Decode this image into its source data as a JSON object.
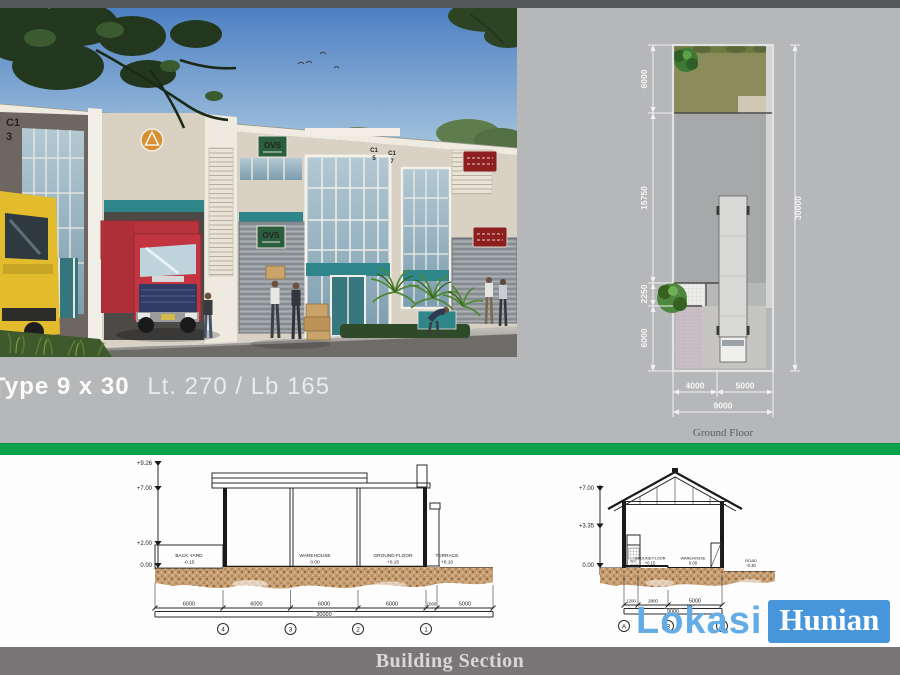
{
  "hero": {
    "caption_bold": "Type 9 x 30",
    "caption_light": "Lt. 270 / Lb 165",
    "signs": {
      "ovs": "OVS",
      "unit1_line1": "C1",
      "unit1_line2": "3",
      "unit2_line1": "C1",
      "unit2_line2": "5",
      "unit3_line1": "C1",
      "unit3_line2": "7"
    }
  },
  "floor_plan": {
    "title": "Ground Floor",
    "left_dims": [
      "6000",
      "15750",
      "2250",
      "6000"
    ],
    "right_dim": "30000",
    "bottom_dims": [
      "4000",
      "5000"
    ],
    "bottom_total": "9000"
  },
  "section_long": {
    "levels": [
      "+9.26",
      "+7.00",
      "+2.00",
      "0.00"
    ],
    "rooms": [
      {
        "name": "BACK YARD",
        "level": "-0.15"
      },
      {
        "name": "WAREHOUSE",
        "level": "0.00"
      },
      {
        "name": "GROUND FLOOR",
        "level": "+0.15"
      },
      {
        "name": "TERRACE",
        "level": "+0.10"
      }
    ],
    "dims": [
      "6000",
      "6000",
      "6000",
      "6000",
      "1000",
      "5000"
    ],
    "total": "30000",
    "grids": [
      "4",
      "3",
      "2",
      "1"
    ]
  },
  "section_cross": {
    "levels": [
      "+7.00",
      "+3.35",
      "0.00"
    ],
    "rooms": [
      {
        "name": "W.C",
        "level": "+0.10"
      },
      {
        "name": "GROUND FLOOR",
        "level": "+0.15"
      },
      {
        "name": "WAREHOUSE",
        "level": "0.00"
      },
      {
        "name": "ROAD",
        "level": "-0.30"
      }
    ],
    "dims": [
      "1200",
      "2800",
      "5000"
    ],
    "total": "9000",
    "grids": [
      "A",
      "B",
      "C"
    ]
  },
  "logo": {
    "first": "Lokasi",
    "second": "Hunian"
  },
  "footer": {
    "title": "Building Section"
  },
  "colors": {
    "accent_green": "#0AA24D",
    "logo_blue": "#4796DB",
    "logo_light_blue": "#63ACE6",
    "top_bar_gray": "#55575A",
    "bottom_bar_gray": "#7A7677",
    "canvas_gray": "#B5B7B9"
  }
}
